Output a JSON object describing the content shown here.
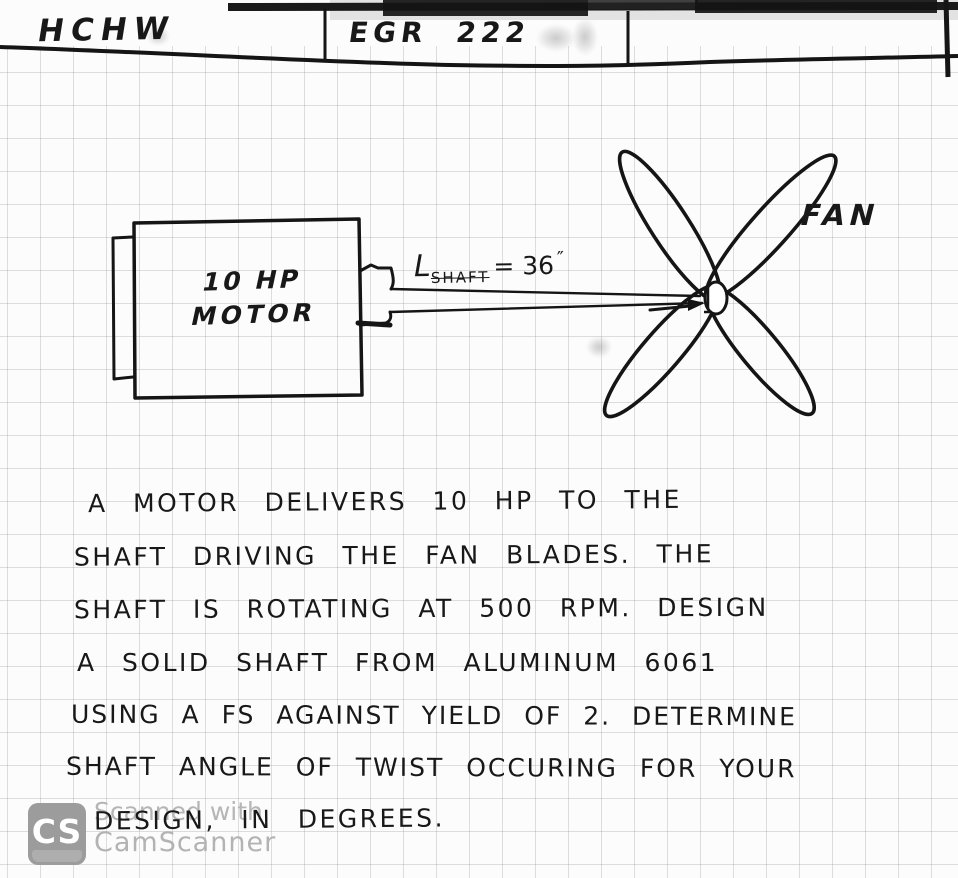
{
  "header": {
    "left_title": "HCHW",
    "course": "EGR 222"
  },
  "diagram": {
    "motor_power": "10 HP",
    "motor_name": "MOTOR",
    "shaft_label": {
      "symbol": "L",
      "subscript": "SHAFT",
      "value": "= 36",
      "unit": "″"
    },
    "fan_label": "FAN",
    "shaft_length_value": 36,
    "shaft_length_unit": "in"
  },
  "problem": {
    "lines": [
      "A MOTOR DELIVERS 10 HP TO THE",
      "SHAFT DRIVING THE FAN BLADES. THE",
      "SHAFT IS ROTATING AT 500 RPM. DESIGN",
      "A SOLID SHAFT FROM ALUMINUM 6061",
      "USING A FS AGAINST YIELD OF 2. DETERMINE",
      "SHAFT ANGLE OF TWIST OCCURING FOR YOUR",
      "DESIGN, IN DEGREES."
    ]
  },
  "watermark": {
    "logo_text": "CS",
    "line1": "Scanned with",
    "line2": "CamScanner"
  },
  "colors": {
    "ink": "#181818",
    "paper": "#fcfcfc",
    "grid_line": "#b9b9b9",
    "watermark_text": "#b5b5b5",
    "watermark_badge": "#9c9c9c"
  }
}
